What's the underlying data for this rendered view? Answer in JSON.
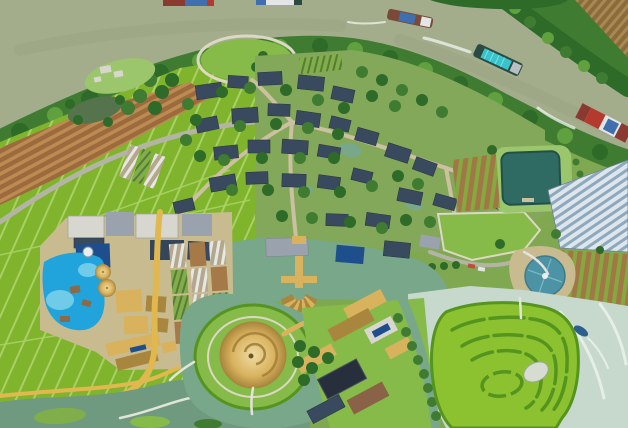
{
  "scene": {
    "title": "Aerial drone view of a canal-side village resort with farmland, ponds, a lagoon pool, a golden spiral-roof pavilion and a crop maze",
    "view": "top-down daytime aerial photograph",
    "boats_count": 5,
    "landmarks": [
      "olive-green river with cargo barges",
      "tree-lined shoreline",
      "oval event lawn with loop path",
      "village of dark tile roofs",
      "bright cyan lagoon swimming pool",
      "golden conical pavilions",
      "central pond with golden pier and raft fan",
      "giant golden spiral round roof on lawn island",
      "crop maze surrounded by pale water",
      "greenhouses and crop rows",
      "paddy field grid",
      "winding canals and golden paths"
    ]
  },
  "palette": {
    "river": "#a3ad8c",
    "riverShadow": "#95a07f",
    "islandBase": "#7fa851",
    "treeDark": "#2e6a28",
    "tree": "#3f7c31",
    "treeLight": "#61a03e",
    "paddy": "#7fb42c",
    "paddyLine": "#a9d064",
    "lawn": "#86bb4a",
    "lawnPale": "#9cc66c",
    "tilled": "#9c6a3c",
    "tilledRow": "#bb8b52",
    "farField": "#8a6b3e",
    "farRow": "#a8894f",
    "road": "#b4b4a6",
    "path": "#cbc0a0",
    "pathLight": "#dcd8c4",
    "boardwalk": "#e2e3d9",
    "villageGround": "#84a85a",
    "roofDark": "#3a4a5e",
    "roofGray": "#9aa3ad",
    "roofNavy": "#1e4f8c",
    "roofSlate": "#36465a",
    "concrete": "#d7d7d0",
    "pool": "#21a4dc",
    "poolLight": "#70cbe9",
    "deck": "#8a6a48",
    "spa": "#e9eff1",
    "goldLight": "#eedca2",
    "gold": "#d9b25e",
    "goldDark": "#a9863d",
    "sandRoad": "#e0b84f",
    "pond": "#78a78a",
    "canal": "#6f9a80",
    "darkPond": "#55734c",
    "mulchBase": "#b3a88e",
    "mulchStripe": "#e7e7e3",
    "plotBrown": "#a57a48",
    "plotGreen": "#7fae4a",
    "plotLine": "#5a7a36",
    "vegDark": "#3d5030",
    "vegRow": "#2a3a22",
    "mazeGreen": "#8cc22f",
    "mazeHedge": "#55941e",
    "mazeIsland": "#d7dcd1",
    "palewater": "#c6d9cc",
    "foam": "#eff5f0",
    "ghWhite": "#dde6ec",
    "ghBlue": "#8fa9bc",
    "cropBrown": "#a07846",
    "cropGreen": "#85a83f",
    "apron": "#c9bb90",
    "disc": "#4d93a6",
    "pondRect": "#2f6b63",
    "pondRectEdge": "#20504a",
    "bargeTeal": "#38c4cc",
    "bargeTealLight": "#7de0e3",
    "bargeRed": "#b43a2e",
    "bargeDarkRed": "#8a3a30",
    "bargeBlue": "#3f6fae",
    "bargeWhite": "#e3e5e7",
    "hullDark": "#2a4a42",
    "hullBrown": "#7a4a38",
    "cabin": "#b9bfc2",
    "boatBlue": "#2b5f8e",
    "carRed": "#c44a3a",
    "carWhite": "#e4e4e0",
    "solar": "#272f3c",
    "solarLine": "#46525f",
    "brownRoof": "#8a6248"
  }
}
